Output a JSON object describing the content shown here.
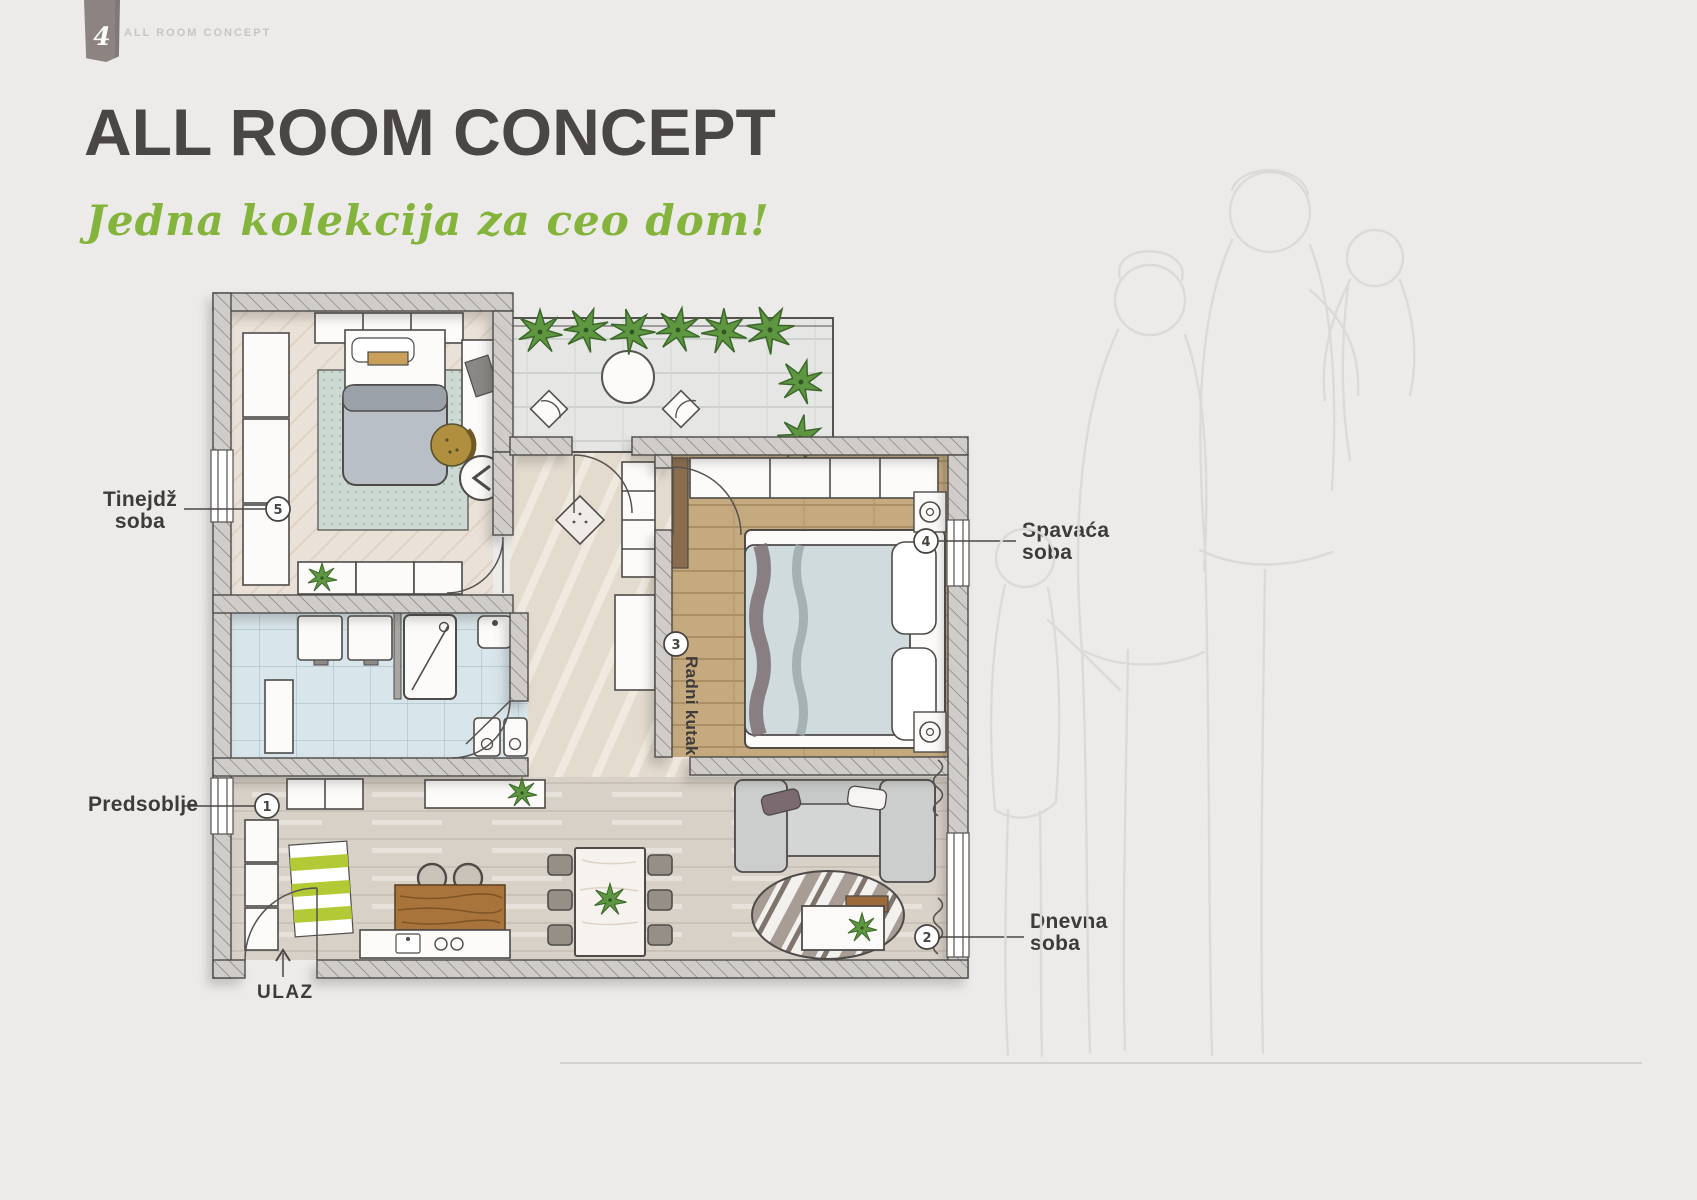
{
  "page": {
    "tab_number": "4",
    "header": "ALL ROOM CONCEPT"
  },
  "hero": {
    "title": "ALL ROOM CONCEPT",
    "subtitle": "Jedna kolekcija za ceo dom!"
  },
  "plan": {
    "rooms": {
      "teen": {
        "name_line1": "Tinejdž",
        "name_line2": "soba",
        "number": "5"
      },
      "hallway": {
        "name": "Predsoblje",
        "number": "1"
      },
      "bedroom": {
        "name_line1": "Spavaća",
        "name_line2": "soba",
        "number": "4"
      },
      "living": {
        "name_line1": "Dnevna",
        "name_line2": "soba",
        "number": "2"
      },
      "work_corner": {
        "name": "Radni kutak",
        "number": "3"
      },
      "entrance": {
        "name": "ULAZ"
      }
    }
  },
  "colors": {
    "background": "#ecebea",
    "title_ink": "#4a4645",
    "accent_green": "#85b43c",
    "ribbon_taupe": "#8d8482",
    "label_ink": "#3e3b3a",
    "wall_fill": "#cfccc9",
    "lime_rug": "#b4c936",
    "wood_brown": "#a9743c",
    "bathroom_tile": "#d6e4ea",
    "plant_green": "#5e9740",
    "bed_blanket_gray": "#b9bfc6",
    "bedroom_bed_blue": "#cfdbdd",
    "sketch_line": "#dcdad7"
  }
}
